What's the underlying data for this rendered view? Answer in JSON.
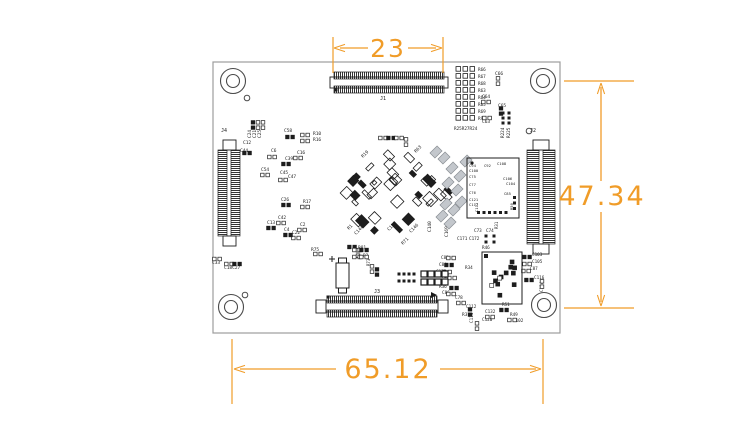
{
  "colors": {
    "dimension": "#F09C28",
    "silk": "#1d1d1d",
    "outline": "#9c9c9c",
    "gray_part": "#c3c7cc"
  },
  "dimensions": {
    "top": {
      "label": "23"
    },
    "right": {
      "label": "47.34"
    },
    "bottom": {
      "label": "65.12"
    }
  },
  "board": {
    "outline": {
      "x": 213,
      "y": 62,
      "w": 347,
      "h": 271
    },
    "holes": [
      {
        "cx": 233,
        "cy": 81
      },
      {
        "cx": 543,
        "cy": 81
      },
      {
        "cx": 231,
        "cy": 307
      },
      {
        "cx": 544,
        "cy": 305
      }
    ],
    "vias": [
      {
        "cx": 247,
        "cy": 98
      },
      {
        "cx": 529,
        "cy": 131
      },
      {
        "cx": 245,
        "cy": 295
      }
    ],
    "connectors": [
      {
        "name": "J1",
        "type": "h",
        "x": 334,
        "y": 72,
        "len": 110,
        "bracket": false,
        "label": {
          "x": 380,
          "y": 100
        }
      },
      {
        "name": "J2",
        "type": "v",
        "x": 527,
        "y": 150,
        "len": 94,
        "bw": 12,
        "sep": 16,
        "label": {
          "x": 530,
          "y": 132
        }
      },
      {
        "name": "J3",
        "type": "h",
        "x": 327,
        "y": 296,
        "len": 110,
        "bracket": true,
        "label": {
          "x": 374,
          "y": 293
        }
      },
      {
        "name": "J4",
        "type": "v",
        "x": 218,
        "y": 150,
        "len": 86,
        "bw": 9,
        "sep": 13,
        "label": {
          "x": 221,
          "y": 132
        }
      }
    ],
    "resistor_bank": {
      "x_pads": 456,
      "x_label": 478,
      "y0": 71,
      "dy": 7,
      "labels": [
        "R66",
        "R67",
        "R68",
        "R63",
        "R64",
        "R65",
        "R69",
        "R90"
      ],
      "bottom_label": "R25R27R24",
      "bottom_x": 454,
      "bottom_y": 130
    },
    "components": [
      {
        "t": "C24",
        "x": 251,
        "y": 138,
        "r": -90,
        "f": 4.5
      },
      {
        "t": "C21",
        "x": 256,
        "y": 138,
        "r": -90,
        "f": 4.5
      },
      {
        "t": "C25",
        "x": 261,
        "y": 138,
        "r": -90,
        "f": 4.5
      },
      {
        "t": "C58",
        "x": 284,
        "y": 132,
        "f": 4.5
      },
      {
        "t": "R10",
        "x": 313,
        "y": 135,
        "f": 4.5
      },
      {
        "t": "R16",
        "x": 313,
        "y": 141,
        "f": 4.5
      },
      {
        "t": "C12",
        "x": 243,
        "y": 144,
        "f": 4.5
      },
      {
        "t": "C44",
        "x": 240,
        "y": 152,
        "f": 4.5
      },
      {
        "t": "C6",
        "x": 271,
        "y": 152,
        "f": 4.5
      },
      {
        "t": "C16",
        "x": 297,
        "y": 154,
        "f": 4.5
      },
      {
        "t": "C39",
        "x": 285,
        "y": 160,
        "f": 4.5
      },
      {
        "t": "C54",
        "x": 261,
        "y": 171,
        "f": 4.5
      },
      {
        "t": "C45",
        "x": 280,
        "y": 174,
        "f": 4.5
      },
      {
        "t": "C47",
        "x": 288,
        "y": 178,
        "f": 4.5
      },
      {
        "t": "C26",
        "x": 281,
        "y": 201,
        "f": 4.5
      },
      {
        "t": "R17",
        "x": 303,
        "y": 203,
        "f": 4.5
      },
      {
        "t": "C42",
        "x": 278,
        "y": 219,
        "f": 4.5
      },
      {
        "t": "C13",
        "x": 267,
        "y": 224,
        "f": 4.5
      },
      {
        "t": "C2",
        "x": 300,
        "y": 226,
        "f": 4.5
      },
      {
        "t": "C4",
        "x": 284,
        "y": 231,
        "f": 4.5
      },
      {
        "t": "C22",
        "x": 292,
        "y": 234,
        "f": 4.5
      },
      {
        "t": "C33",
        "x": 212,
        "y": 264,
        "f": 4.5
      },
      {
        "t": "C18C27",
        "x": 224,
        "y": 269,
        "f": 4.5
      },
      {
        "t": "R19",
        "x": 363,
        "y": 158,
        "r": -45,
        "f": 4.5
      },
      {
        "t": "R63",
        "x": 416,
        "y": 153,
        "r": -45,
        "f": 4.5
      },
      {
        "t": "R1",
        "x": 349,
        "y": 230,
        "r": -45,
        "f": 4.5
      },
      {
        "t": "C144",
        "x": 356,
        "y": 235,
        "r": -45,
        "f": 4.5
      },
      {
        "t": "C137",
        "x": 389,
        "y": 231,
        "r": -45,
        "f": 4.5
      },
      {
        "t": "C146",
        "x": 411,
        "y": 233,
        "r": -45,
        "f": 4.5
      },
      {
        "t": "R71",
        "x": 403,
        "y": 245,
        "r": -45,
        "f": 4.5
      },
      {
        "t": "R81",
        "x": 358,
        "y": 249,
        "f": 4.5
      },
      {
        "t": "C140",
        "x": 431,
        "y": 232,
        "r": -90,
        "f": 4.5
      },
      {
        "t": "C169",
        "x": 448,
        "y": 237,
        "r": -90,
        "f": 4.5
      },
      {
        "t": "R75",
        "x": 311,
        "y": 251,
        "f": 4.5
      },
      {
        "t": "R3",
        "x": 363,
        "y": 257,
        "f": 4.5
      },
      {
        "t": "R73",
        "x": 370,
        "y": 266,
        "r": -90,
        "f": 4
      },
      {
        "t": "R224",
        "x": 504,
        "y": 138,
        "r": -90,
        "f": 4.3
      },
      {
        "t": "R225",
        "x": 510,
        "y": 138,
        "r": -90,
        "f": 4.3
      },
      {
        "t": "C66",
        "x": 495,
        "y": 75,
        "f": 4.5
      },
      {
        "t": "C64",
        "x": 482,
        "y": 98,
        "f": 4.5
      },
      {
        "t": "C65",
        "x": 498,
        "y": 107,
        "f": 4.5
      },
      {
        "t": "C63",
        "x": 482,
        "y": 123,
        "f": 4.5
      },
      {
        "t": "C94",
        "x": 469,
        "y": 167,
        "f": 3.8
      },
      {
        "t": "C100",
        "x": 469,
        "y": 172,
        "f": 3.8
      },
      {
        "t": "C92",
        "x": 484,
        "y": 167,
        "f": 3.8
      },
      {
        "t": "C108",
        "x": 497,
        "y": 165,
        "f": 3.8
      },
      {
        "t": "C75",
        "x": 469,
        "y": 178,
        "f": 3.8
      },
      {
        "t": "C106",
        "x": 503,
        "y": 180,
        "f": 3.8
      },
      {
        "t": "C104",
        "x": 506,
        "y": 185,
        "f": 3.8
      },
      {
        "t": "C77",
        "x": 469,
        "y": 186,
        "f": 3.8
      },
      {
        "t": "C76",
        "x": 469,
        "y": 194,
        "f": 3.8
      },
      {
        "t": "C85",
        "x": 504,
        "y": 195,
        "f": 3.8
      },
      {
        "t": "C121",
        "x": 469,
        "y": 201,
        "f": 3.8
      },
      {
        "t": "C117",
        "x": 469,
        "y": 206,
        "f": 3.8
      },
      {
        "t": "C111",
        "x": 478,
        "y": 212,
        "r": -90,
        "f": 3.8
      },
      {
        "t": "R50",
        "x": 513,
        "y": 210,
        "r": -90,
        "f": 3.8
      },
      {
        "t": "C73",
        "x": 474,
        "y": 232,
        "f": 4.3
      },
      {
        "t": "C74",
        "x": 486,
        "y": 232,
        "f": 4.3
      },
      {
        "t": "C171",
        "x": 457,
        "y": 240,
        "f": 4.3
      },
      {
        "t": "C172",
        "x": 469,
        "y": 240,
        "f": 4.3
      },
      {
        "t": "R31",
        "x": 498,
        "y": 229,
        "r": -90,
        "f": 4
      },
      {
        "t": "R46",
        "x": 482,
        "y": 249,
        "f": 4.3
      },
      {
        "t": "C103",
        "x": 532,
        "y": 256,
        "f": 4.3
      },
      {
        "t": "C105",
        "x": 532,
        "y": 263,
        "f": 4.3
      },
      {
        "t": "C87",
        "x": 530,
        "y": 270,
        "f": 4.3
      },
      {
        "t": "C116",
        "x": 534,
        "y": 279,
        "f": 4.3
      },
      {
        "t": "C134",
        "x": 543,
        "y": 292,
        "r": -90,
        "f": 4.3
      },
      {
        "t": "C83",
        "x": 441,
        "y": 259,
        "f": 4.3
      },
      {
        "t": "C84",
        "x": 439,
        "y": 266,
        "f": 4.3
      },
      {
        "t": "C172",
        "x": 436,
        "y": 273,
        "f": 4.3
      },
      {
        "t": "R34",
        "x": 465,
        "y": 269,
        "f": 4.3
      },
      {
        "t": "R35",
        "x": 442,
        "y": 278,
        "f": 4.3
      },
      {
        "t": "R36",
        "x": 439,
        "y": 288,
        "f": 4.3
      },
      {
        "t": "C86",
        "x": 442,
        "y": 294,
        "f": 4.3
      },
      {
        "t": "C78",
        "x": 455,
        "y": 299,
        "f": 4.3
      },
      {
        "t": "R37",
        "x": 462,
        "y": 316,
        "f": 4.5
      },
      {
        "t": "C112",
        "x": 466,
        "y": 308,
        "f": 4.3
      },
      {
        "t": "C114",
        "x": 473,
        "y": 323,
        "r": -90,
        "f": 4.3
      },
      {
        "t": "C132",
        "x": 485,
        "y": 313,
        "f": 4.3
      },
      {
        "t": "C120",
        "x": 482,
        "y": 321,
        "f": 4.3
      },
      {
        "t": "R51",
        "x": 502,
        "y": 306,
        "f": 4.3
      },
      {
        "t": "R49",
        "x": 510,
        "y": 316,
        "f": 4.3
      },
      {
        "t": "C102",
        "x": 513,
        "y": 322,
        "f": 4.3
      }
    ],
    "pads": [
      [
        290,
        137,
        0
      ],
      [
        305,
        135,
        0
      ],
      [
        305,
        141,
        0
      ],
      [
        253,
        125,
        90
      ],
      [
        258,
        125,
        90
      ],
      [
        263,
        125,
        90
      ],
      [
        247,
        153,
        0
      ],
      [
        272,
        157,
        0
      ],
      [
        298,
        158,
        0
      ],
      [
        286,
        164,
        0
      ],
      [
        265,
        175,
        0
      ],
      [
        283,
        180,
        0
      ],
      [
        286,
        205,
        0
      ],
      [
        305,
        207,
        0
      ],
      [
        281,
        223,
        0
      ],
      [
        271,
        228,
        0
      ],
      [
        302,
        230,
        0
      ],
      [
        296,
        238,
        0
      ],
      [
        288,
        235,
        0
      ],
      [
        217,
        259,
        0
      ],
      [
        229,
        264,
        0
      ],
      [
        237,
        264,
        0
      ],
      [
        498,
        81,
        90
      ],
      [
        486,
        102,
        0
      ],
      [
        501,
        111,
        90
      ],
      [
        487,
        118,
        0
      ],
      [
        383,
        138,
        0
      ],
      [
        391,
        138,
        0
      ],
      [
        399,
        138,
        0
      ],
      [
        406,
        142,
        90
      ],
      [
        352,
        247,
        0
      ],
      [
        358,
        253,
        90
      ],
      [
        372,
        269,
        90
      ],
      [
        377,
        272,
        90
      ],
      [
        318,
        254,
        0
      ],
      [
        357,
        250,
        0
      ],
      [
        364,
        250,
        0
      ],
      [
        357,
        257,
        0
      ],
      [
        364,
        257,
        0
      ],
      [
        527,
        257,
        0
      ],
      [
        527,
        264,
        0
      ],
      [
        526,
        271,
        0
      ],
      [
        529,
        280,
        0
      ],
      [
        542,
        284,
        90
      ],
      [
        451,
        258,
        0
      ],
      [
        449,
        265,
        0
      ],
      [
        447,
        272,
        0
      ],
      [
        452,
        278,
        0
      ],
      [
        454,
        288,
        0
      ],
      [
        451,
        294,
        0
      ],
      [
        461,
        303,
        0
      ],
      [
        470,
        312,
        90
      ],
      [
        477,
        326,
        90
      ],
      [
        490,
        317,
        0
      ],
      [
        504,
        310,
        0
      ],
      [
        512,
        320,
        0
      ]
    ],
    "dots": [
      [
        503,
        113
      ],
      [
        509,
        113
      ],
      [
        503,
        118
      ],
      [
        509,
        118
      ],
      [
        503,
        123
      ],
      [
        509,
        123
      ],
      [
        336,
        90
      ],
      [
        328,
        297
      ],
      [
        486,
        236
      ],
      [
        494,
        236
      ],
      [
        486,
        242
      ],
      [
        494,
        242
      ],
      [
        399,
        274
      ],
      [
        399,
        281
      ],
      [
        404,
        274
      ],
      [
        404,
        281
      ],
      [
        409,
        274
      ],
      [
        409,
        281
      ],
      [
        414,
        274
      ],
      [
        414,
        281
      ]
    ],
    "qfn": {
      "x": 467,
      "y": 158,
      "w": 52,
      "h": 60
    },
    "ic2": {
      "x": 482,
      "y": 252,
      "w": 40,
      "h": 52
    },
    "jumper_grid": {
      "x": 421,
      "y": 271,
      "cols": 4,
      "rows": 2,
      "cell": 7,
      "size": 6
    },
    "electrolytic": {
      "x": 336,
      "y": 263,
      "w": 13,
      "h": 25,
      "plus_x": 332,
      "plus_y": 259
    },
    "cluster": {
      "cx": 391,
      "cy": 190,
      "rx": 58,
      "ry": 48,
      "count": 60
    },
    "gray_parts": [
      [
        452,
        168
      ],
      [
        460,
        176
      ],
      [
        448,
        183
      ],
      [
        457,
        190
      ],
      [
        466,
        161
      ],
      [
        446,
        204
      ],
      [
        454,
        210
      ],
      [
        461,
        202
      ],
      [
        442,
        216
      ],
      [
        450,
        223
      ],
      [
        436,
        152
      ],
      [
        444,
        158
      ]
    ]
  }
}
